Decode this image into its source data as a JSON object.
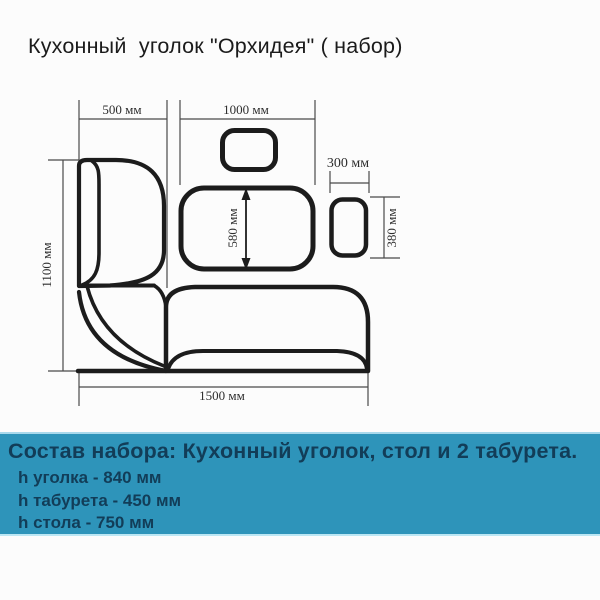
{
  "title": "Кухонный  уголок \"Орхидея\" ( набор)",
  "diagram": {
    "labels": {
      "bench_width": "500 мм",
      "table_length": "1000 мм",
      "stool_width": "300 мм",
      "stool_depth": "380 мм",
      "table_depth": "580 мм",
      "bench_length": "1100 мм",
      "set_length": "1500 мм"
    }
  },
  "footer": {
    "heading": "Состав набора: Кухонный уголок, стол и 2 табурета.",
    "items": [
      "h уголка - 840 мм",
      "h табурета - 450 мм",
      "h стола - 750 мм"
    ]
  },
  "colors": {
    "band_background": "#2e94ba",
    "band_text": "#123d58",
    "line_color": "#1c1c1c",
    "dim_line_color": "#4a4a4a"
  }
}
